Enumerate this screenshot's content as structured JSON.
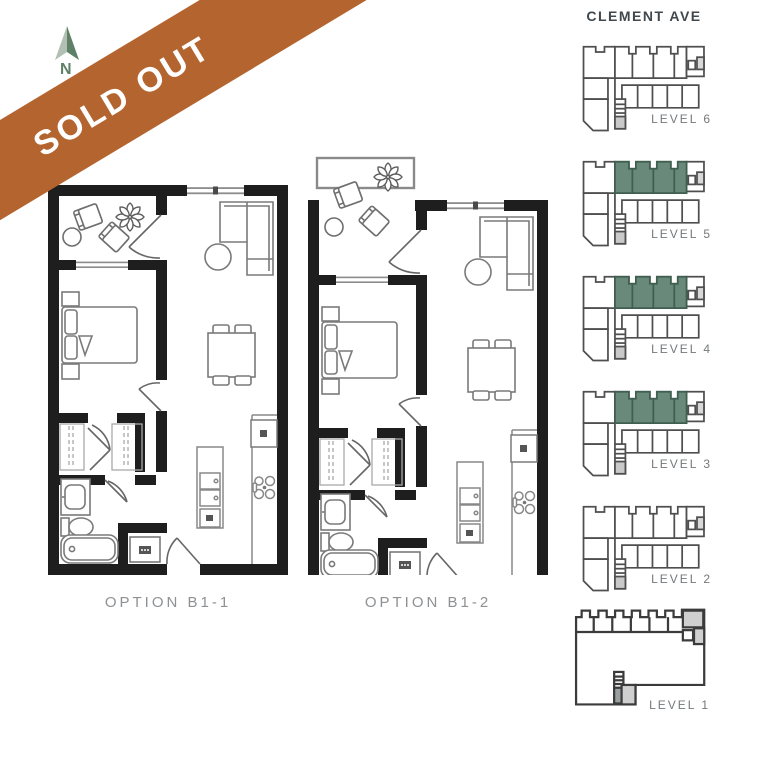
{
  "banner": {
    "label": "SOLD OUT",
    "color": "#B4652F",
    "text_color": "#FFFFFF"
  },
  "compass": {
    "label": "N",
    "color": "#5D8066"
  },
  "floor_plans": [
    {
      "id": "B1-1",
      "caption": "OPTION B1-1",
      "balcony": "recessed"
    },
    {
      "id": "B1-2",
      "caption": "OPTION B1-2",
      "balcony": "protruding"
    }
  ],
  "key_plan": {
    "street_label": "CLEMENT AVE",
    "highlight_color": "#69897A",
    "levels": [
      {
        "label": "LEVEL 6",
        "highlighted": false,
        "footprint": "typical"
      },
      {
        "label": "LEVEL 5",
        "highlighted": true,
        "footprint": "typical"
      },
      {
        "label": "LEVEL 4",
        "highlighted": true,
        "footprint": "typical"
      },
      {
        "label": "LEVEL 3",
        "highlighted": true,
        "footprint": "typical"
      },
      {
        "label": "LEVEL 2",
        "highlighted": false,
        "footprint": "typical"
      },
      {
        "label": "LEVEL 1",
        "highlighted": false,
        "footprint": "ground"
      }
    ]
  }
}
